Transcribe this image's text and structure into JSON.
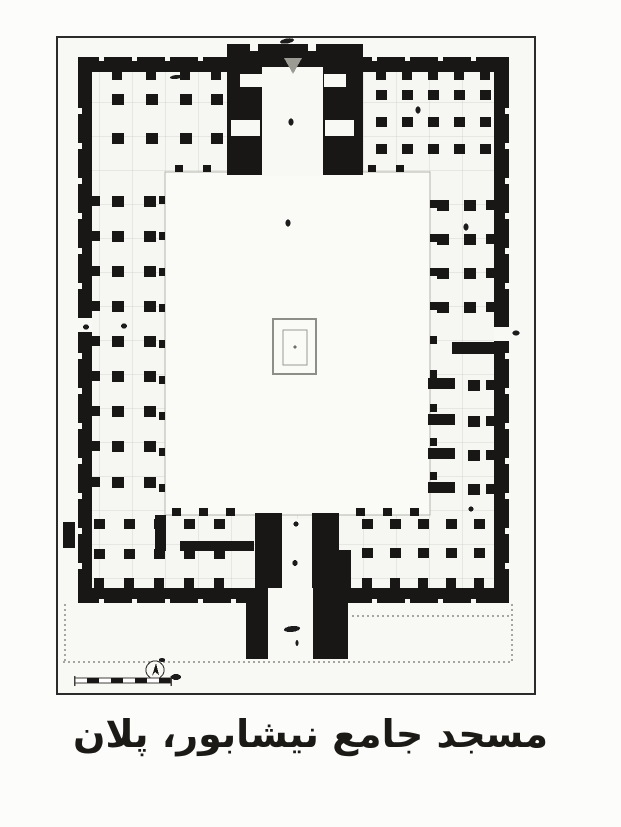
{
  "page": {
    "background": "#fcfcfa"
  },
  "caption": {
    "text": "مسجد جامع نیشابور، پلان"
  },
  "colors": {
    "ink": "#181715",
    "paper": "#f8f8f5",
    "hall": "#f6f6f2",
    "grid": "#c9c9c3",
    "frame": "#2b2b2b",
    "courtyard": "#fafaf7",
    "courtyard_edge": "#b5b5af",
    "pool": "#8e8e88",
    "mark": "#1c1c1c",
    "dotted": "#55524c"
  },
  "figure": {
    "frame": {
      "x": 57,
      "y": 37,
      "w": 478,
      "h": 657
    },
    "interior": {
      "x": 92,
      "y": 72,
      "w": 402,
      "h": 516
    },
    "courtyard": {
      "x": 165,
      "y": 172,
      "w": 265,
      "h": 343
    }
  },
  "plan": {
    "walls": [
      {
        "name": "north-wall-west",
        "x": 78,
        "y": 57,
        "w": 150,
        "h": 15
      },
      {
        "name": "north-wall-east",
        "x": 362,
        "y": 57,
        "w": 147,
        "h": 15
      },
      {
        "name": "west-wall",
        "x": 78,
        "y": 57,
        "w": 14,
        "h": 546
      },
      {
        "name": "east-wall",
        "x": 494,
        "y": 57,
        "w": 15,
        "h": 546
      },
      {
        "name": "south-wall",
        "x": 78,
        "y": 588,
        "w": 431,
        "h": 15
      },
      {
        "name": "east-wing-divider-wall",
        "x": 452,
        "y": 342,
        "w": 45,
        "h": 12
      },
      {
        "name": "southwest-room-wall",
        "x": 155,
        "y": 515,
        "w": 11,
        "h": 36
      },
      {
        "name": "southwest-room-wall",
        "x": 180,
        "y": 541,
        "w": 74,
        "h": 10
      },
      {
        "name": "southwest-buttress",
        "x": 63,
        "y": 522,
        "w": 12,
        "h": 26
      }
    ],
    "black_masses": [
      {
        "name": "north-iwan-block",
        "x": 227,
        "y": 44,
        "w": 136,
        "h": 131
      },
      {
        "name": "south-iwan-pier-left",
        "x": 255,
        "y": 513,
        "w": 27,
        "h": 78
      },
      {
        "name": "south-iwan-pier-right",
        "x": 312,
        "y": 513,
        "w": 27,
        "h": 40
      },
      {
        "name": "south-iwan-pier-right-ext",
        "x": 312,
        "y": 550,
        "w": 39,
        "h": 41
      },
      {
        "name": "portal-tower-left",
        "x": 246,
        "y": 603,
        "w": 22,
        "h": 56
      },
      {
        "name": "portal-tower-right",
        "x": 313,
        "y": 603,
        "w": 35,
        "h": 56
      }
    ],
    "white_openings": [
      {
        "name": "north-iwan-chamber",
        "x": 262,
        "y": 67,
        "w": 61,
        "h": 109
      },
      {
        "name": "iwan-niche",
        "x": 240,
        "y": 74,
        "w": 22,
        "h": 13
      },
      {
        "name": "iwan-niche",
        "x": 231,
        "y": 120,
        "w": 29,
        "h": 16
      },
      {
        "name": "iwan-niche",
        "x": 324,
        "y": 74,
        "w": 22,
        "h": 13
      },
      {
        "name": "iwan-niche",
        "x": 325,
        "y": 120,
        "w": 29,
        "h": 16
      },
      {
        "name": "iwan-notch",
        "x": 250,
        "y": 44,
        "w": 8,
        "h": 7
      },
      {
        "name": "iwan-notch",
        "x": 308,
        "y": 44,
        "w": 8,
        "h": 7
      },
      {
        "name": "west-entrance-gap",
        "x": 78,
        "y": 318,
        "w": 14,
        "h": 14
      },
      {
        "name": "east-entrance-gap",
        "x": 494,
        "y": 327,
        "w": 15,
        "h": 14
      },
      {
        "name": "south-iwan-chamber",
        "x": 282,
        "y": 519,
        "w": 30,
        "h": 70
      },
      {
        "name": "south-portal-corridor",
        "x": 268,
        "y": 588,
        "w": 45,
        "h": 71
      }
    ],
    "column_zones": [
      {
        "name": "northwest-hypostyle",
        "xs": [
          112,
          146,
          180,
          211
        ],
        "ys": [
          94,
          133
        ],
        "w": 12,
        "h": 11
      },
      {
        "name": "northeast-hypostyle",
        "xs": [
          376,
          402,
          428,
          454,
          480
        ],
        "ys": [
          90,
          117,
          144
        ],
        "w": 11,
        "h": 10
      },
      {
        "name": "west-wing-hypostyle",
        "xs": [
          112,
          144
        ],
        "ys": [
          196,
          231,
          266,
          301,
          336,
          371,
          406,
          441,
          477
        ],
        "w": 12,
        "h": 11
      },
      {
        "name": "east-wing-upper-hypostyle",
        "xs": [
          437,
          464
        ],
        "ys": [
          200,
          234,
          268,
          302
        ],
        "w": 12,
        "h": 11
      },
      {
        "name": "east-wing-lower-hypostyle",
        "xs": [
          468
        ],
        "ys": [
          380,
          416,
          450,
          484
        ],
        "w": 12,
        "h": 11
      },
      {
        "name": "southwest-hypostyle",
        "xs": [
          94,
          124,
          154,
          184,
          214
        ],
        "ys": [
          519,
          549
        ],
        "w": 11,
        "h": 10
      },
      {
        "name": "southeast-hypostyle",
        "xs": [
          362,
          390,
          418,
          446,
          474
        ],
        "ys": [
          519,
          548
        ],
        "w": 11,
        "h": 10
      }
    ],
    "pier_bars": [
      {
        "x": 428,
        "y": 378,
        "w": 27,
        "h": 11
      },
      {
        "x": 428,
        "y": 414,
        "w": 27,
        "h": 11
      },
      {
        "x": 428,
        "y": 448,
        "w": 27,
        "h": 11
      },
      {
        "x": 428,
        "y": 482,
        "w": 27,
        "h": 11
      }
    ],
    "ink_dashes": [
      {
        "axis": "x",
        "fixed": 72,
        "w": 10,
        "h": 8,
        "positions": [
          112,
          146,
          180,
          211,
          376,
          402,
          428,
          454,
          480
        ]
      },
      {
        "axis": "y",
        "fixed": 92,
        "w": 8,
        "h": 10,
        "positions": [
          196,
          231,
          266,
          301,
          336,
          371,
          406,
          441,
          477
        ]
      },
      {
        "axis": "y",
        "fixed": 486,
        "w": 8,
        "h": 10,
        "positions": [
          200,
          234,
          268,
          302,
          380,
          416,
          450,
          484
        ]
      },
      {
        "axis": "x",
        "fixed": 578,
        "w": 10,
        "h": 10,
        "positions": [
          94,
          124,
          154,
          184,
          214,
          362,
          390,
          418,
          446,
          474
        ]
      },
      {
        "axis": "x",
        "fixed": 165,
        "w": 8,
        "h": 7,
        "positions": [
          175,
          203,
          368,
          396
        ]
      },
      {
        "axis": "y",
        "fixed": 159,
        "w": 6,
        "h": 8,
        "positions": [
          196,
          232,
          268,
          304,
          340,
          376,
          412,
          448,
          484
        ]
      },
      {
        "axis": "y",
        "fixed": 430,
        "w": 7,
        "h": 8,
        "positions": [
          200,
          234,
          268,
          302,
          336,
          370,
          404,
          438,
          472
        ]
      },
      {
        "axis": "x",
        "fixed": 508,
        "w": 9,
        "h": 8,
        "positions": [
          172,
          199,
          226,
          356,
          383,
          410
        ]
      }
    ],
    "white_dashes": [
      {
        "axis": "x",
        "fixed": 57,
        "w": 5,
        "h": 4,
        "positions": [
          99,
          132,
          165,
          198,
          372,
          405,
          438,
          471
        ]
      },
      {
        "axis": "y",
        "fixed": 78,
        "w": 4,
        "h": 6,
        "positions": [
          108,
          143,
          178,
          213,
          248,
          283,
          353,
          388,
          423,
          458,
          493,
          528,
          563
        ]
      },
      {
        "axis": "y",
        "fixed": 505,
        "w": 4,
        "h": 6,
        "positions": [
          108,
          143,
          178,
          213,
          248,
          283,
          353,
          388,
          423,
          458,
          493,
          528,
          563
        ]
      },
      {
        "axis": "x",
        "fixed": 599,
        "w": 5,
        "h": 4,
        "positions": [
          99,
          132,
          165,
          198,
          231,
          372,
          405,
          438,
          471
        ]
      }
    ],
    "pool": {
      "outer": {
        "x": 273,
        "y": 319,
        "w": 43,
        "h": 55
      },
      "inner": {
        "x": 283,
        "y": 330,
        "w": 24,
        "h": 35
      },
      "dot": {
        "cx": 295,
        "cy": 347
      }
    },
    "mihrab_triangle": {
      "points": "284,58 302,58 293,74"
    },
    "dotted_lines": [
      {
        "x1": 352,
        "y1": 616,
        "x2": 509,
        "y2": 616
      },
      {
        "x1": 63,
        "y1": 662,
        "x2": 512,
        "y2": 662
      },
      {
        "x1": 65,
        "y1": 604,
        "x2": 65,
        "y2": 662
      },
      {
        "x1": 512,
        "y1": 604,
        "x2": 512,
        "y2": 662
      }
    ],
    "compass": {
      "cx": 155,
      "cy": 670,
      "r": 9
    },
    "scalebar": {
      "x": 75,
      "y": 678,
      "h": 5,
      "seg_w": 12,
      "segs": 8
    },
    "marks": [
      {
        "cx": 287,
        "cy": 41,
        "rx": 7,
        "ry": 2.5,
        "rot": -10
      },
      {
        "cx": 176,
        "cy": 77,
        "rx": 6,
        "ry": 2,
        "rot": -6
      },
      {
        "cx": 291,
        "cy": 122,
        "rx": 2.5,
        "ry": 3.5,
        "rot": 0
      },
      {
        "cx": 288,
        "cy": 223,
        "rx": 2.5,
        "ry": 3.5,
        "rot": 0
      },
      {
        "cx": 418,
        "cy": 110,
        "rx": 2.5,
        "ry": 3.5,
        "rot": 0
      },
      {
        "cx": 466,
        "cy": 227,
        "rx": 2.5,
        "ry": 3.5,
        "rot": 0
      },
      {
        "cx": 124,
        "cy": 326,
        "rx": 3,
        "ry": 2.5,
        "rot": 0
      },
      {
        "cx": 86,
        "cy": 327,
        "rx": 3,
        "ry": 2.5,
        "rot": 0
      },
      {
        "cx": 516,
        "cy": 333,
        "rx": 3.5,
        "ry": 2.5,
        "rot": 0
      },
      {
        "cx": 471,
        "cy": 509,
        "rx": 2.5,
        "ry": 2.5,
        "rot": 0
      },
      {
        "cx": 296,
        "cy": 524,
        "rx": 2.5,
        "ry": 2.5,
        "rot": 0
      },
      {
        "cx": 295,
        "cy": 563,
        "rx": 2.5,
        "ry": 3,
        "rot": 0
      },
      {
        "cx": 292,
        "cy": 629,
        "rx": 8,
        "ry": 3,
        "rot": -6
      },
      {
        "cx": 297,
        "cy": 643,
        "rx": 1.5,
        "ry": 3,
        "rot": 0
      },
      {
        "cx": 176,
        "cy": 677,
        "rx": 5,
        "ry": 3,
        "rot": 0
      }
    ]
  }
}
